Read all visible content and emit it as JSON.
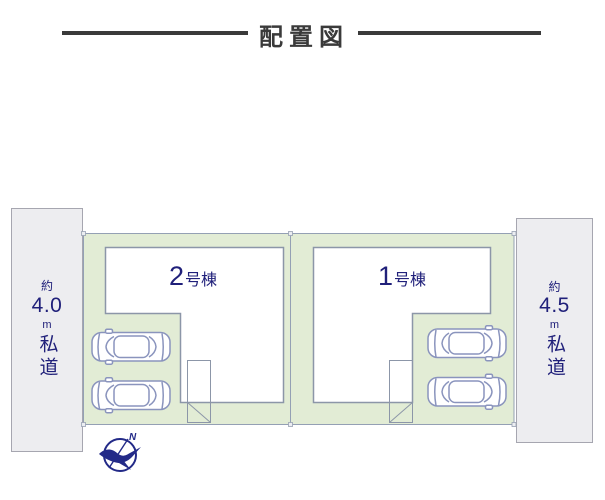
{
  "title": {
    "text": "配置図"
  },
  "roads": {
    "left": {
      "approx": "約",
      "value": "4.0",
      "unit": "m",
      "label": "私道"
    },
    "right": {
      "approx": "約",
      "value": "4.5",
      "unit": "m",
      "label": "私道"
    }
  },
  "buildings": {
    "b2": {
      "number": "2",
      "suffix": "号棟"
    },
    "b1": {
      "number": "1",
      "suffix": "号棟"
    }
  },
  "compass": {
    "north": "N"
  },
  "colors": {
    "title_ink": "#3a3a3a",
    "navy": "#20207a",
    "lot_fill": "#e2ecd5",
    "lot_border": "#94a0b4",
    "road_fill": "#ededf0",
    "road_border": "#a6a6b0",
    "building_fill": "#ffffff",
    "building_border": "#8c96a8",
    "car_stroke": "#8a94bd",
    "compass_navy": "#232a88"
  }
}
